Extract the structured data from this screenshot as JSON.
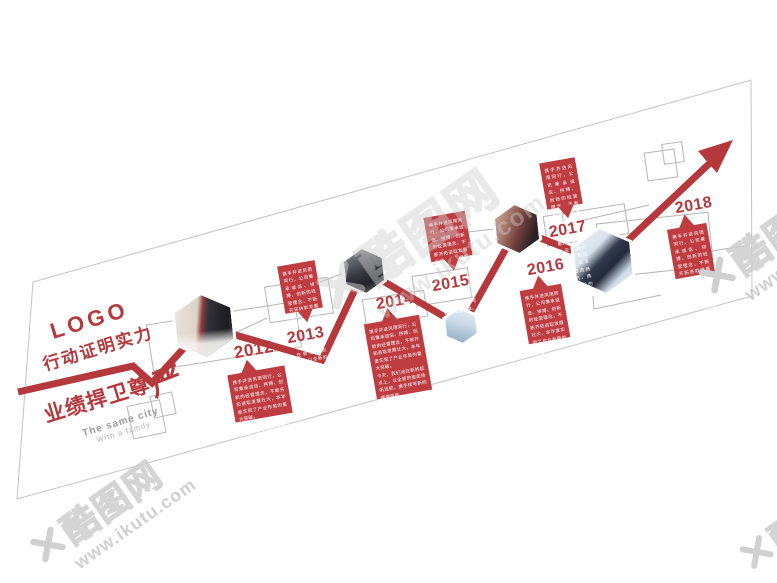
{
  "brand_watermark": {
    "site_name": "酷图网",
    "site_url": "www.ikutu.com",
    "logo_icon": "ikutu-x-logo"
  },
  "header": {
    "logo": "LOGO",
    "slogan_line1": "行动证明实力",
    "slogan_line2_main": "业绩捍卫尊",
    "slogan_line2_last": "严",
    "tagline_line1": "The same city",
    "tagline_line2": "With a family"
  },
  "timeline": {
    "direction": "ascending left to right with red growth arrow",
    "milestones": [
      {
        "year": "2012",
        "body": "携手并进风雨同行，公司秉承诚信、拼搏、创新的经营理念，不断开拓进取发展壮大，本年度实现了产业布局的重大突破。\n今天，我们站在新的起点上，以全新的姿态扬帆远航，携手续写新的辉煌篇章。"
      },
      {
        "year": "2013",
        "body": "携手并进风雨同行，公司秉承诚信、拼搏、创新的经营理念，不断开拓进取发展壮大，本年度实现了产业布局的重大突破。\n今天，我们站在新的起点上，以全新的姿态扬帆远航，携手续写新的辉煌篇章。"
      },
      {
        "year": "2014",
        "body": "携手并进风雨同行，公司秉承诚信、拼搏、创新的经营理念，不断开拓进取发展壮大，本年度实现了产业布局的重大突破。\n今天，我们站在新的起点上，以全新的姿态扬帆远航，携手续写新的辉煌篇章。"
      },
      {
        "year": "2015",
        "body": "携手并进风雨同行，公司秉承诚信、拼搏、创新的经营理念，不断开拓进取发展壮大，本年度实现了产业布局的重大突破。\n今天，我们站在新的起点上，以全新的姿态扬帆远航，携手续写新的辉煌篇章。"
      },
      {
        "year": "2016",
        "body": "携手并进风雨同行，公司秉承诚信、拼搏、创新的经营理念，不断开拓进取发展壮大，本年度实现了产业布局的重大突破。\n今天，我们站在新的起点上，以全新的姿态扬帆远航，携手续写新的辉煌篇章。"
      },
      {
        "year": "2017",
        "body": "携手并进风雨同行，公司秉承诚信、拼搏、创新的经营理念，不断开拓进取发展壮大，本年度实现了产业布局的重大突破。\n今天，我们站在新的起点上，以全新的姿态扬帆远航，携手续写新的辉煌篇章。"
      },
      {
        "year": "2018",
        "body": "携手并进风雨同行，公司秉承诚信、拼搏、创新的经营理念，不断开拓进取发展壮大，本年度实现了产业布局的重大突破。\n今天，我们站在新的起点上，以全新的姿态扬帆远航，携手续写新的辉煌篇章。"
      }
    ]
  },
  "photos": [
    {
      "name": "office-display",
      "alt": "man in black suit beside white shelf with red product boxes"
    },
    {
      "name": "businessman-suit",
      "alt": "close-up of businessman in dark suit"
    },
    {
      "name": "skyscraper",
      "alt": "modern glass building against sky"
    },
    {
      "name": "business-meeting",
      "alt": "team meeting around office desk"
    },
    {
      "name": "handshake",
      "alt": "business handshake in suits"
    }
  ],
  "colors": {
    "accent_red": "#b5383d",
    "bubble_red": "#bf3c40",
    "structure_gray": "#b5b5b5",
    "wall_outline_gray": "#c4c4c4",
    "watermark_gray": "#d5d5d5"
  }
}
